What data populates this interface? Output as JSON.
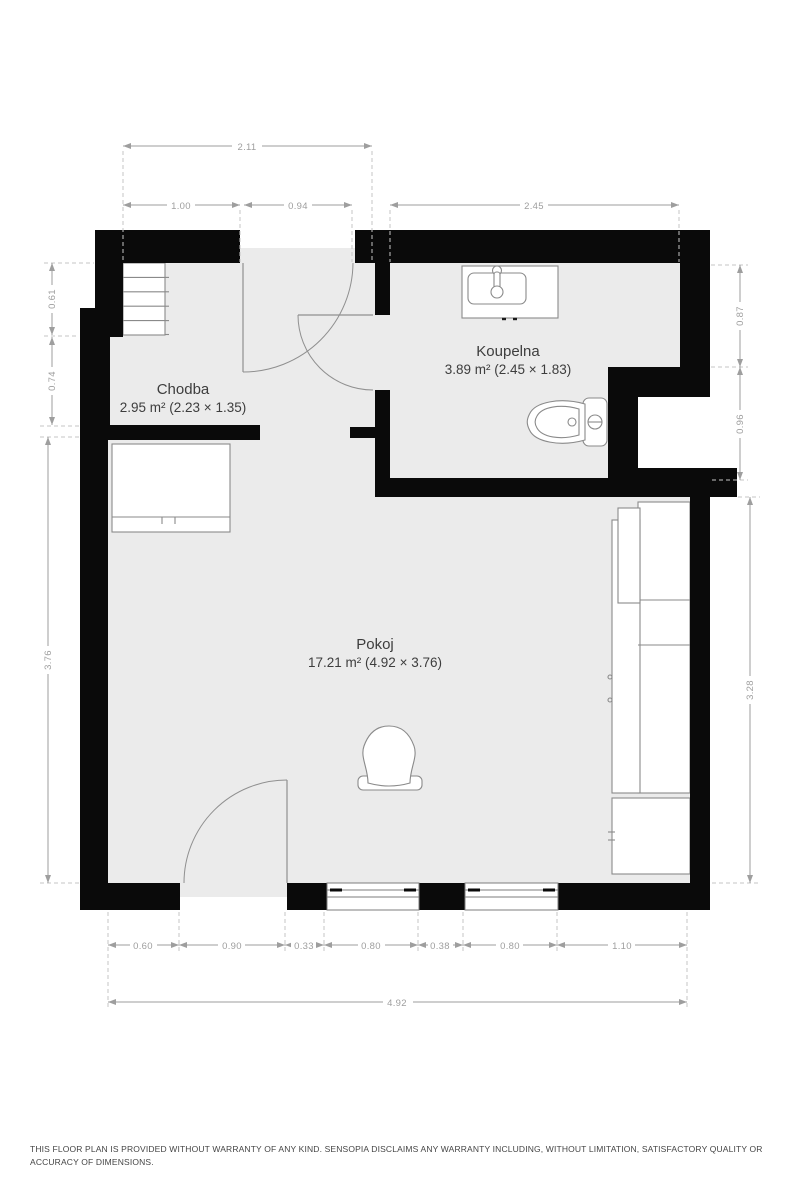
{
  "rooms": [
    {
      "name": "Chodba",
      "area": "2.95 m² (2.23 × 1.35)"
    },
    {
      "name": "Koupelna",
      "area": "3.89 m² (2.45 × 1.83)"
    },
    {
      "name": "Pokoj",
      "area": "17.21 m² (4.92 × 3.76)"
    }
  ],
  "dimensions": {
    "top_total": "2.11",
    "top_segments": [
      "1.00",
      "0.94",
      "2.45"
    ],
    "left": [
      "0.61",
      "0.74",
      "3.76"
    ],
    "right": [
      "0.87",
      "0.96",
      "3.28"
    ],
    "bottom_segments": [
      "0.60",
      "0.90",
      "0.33",
      "0.80",
      "0.38",
      "0.80",
      "1.10"
    ],
    "bottom_total": "4.92"
  },
  "fixtures": [
    "staircase",
    "hallway-counter",
    "sink-vanity",
    "toilet",
    "wardrobe",
    "cabinet",
    "armchair"
  ],
  "colors": {
    "wall": "#0a0a0a",
    "floor": "#ebebeb",
    "fixture_stroke": "#8a8a8a",
    "dimension": "#9e9e9e",
    "room_label": "#3d3d3d"
  },
  "disclaimer": "THIS FLOOR PLAN IS PROVIDED WITHOUT WARRANTY OF ANY KIND. SENSOPIA DISCLAIMS ANY WARRANTY INCLUDING, WITHOUT LIMITATION, SATISFACTORY QUALITY OR ACCURACY OF DIMENSIONS."
}
